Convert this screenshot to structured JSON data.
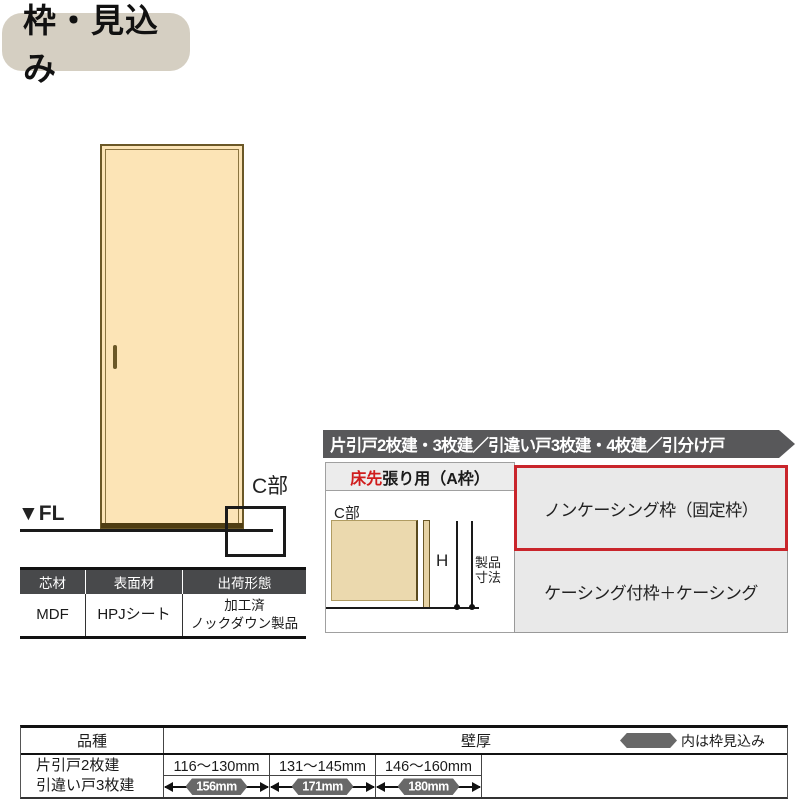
{
  "page_title": "枠・見込み",
  "door_figure": {
    "fl_label": "▼FL",
    "c_section_label": "C部"
  },
  "materials_table": {
    "headers": [
      "芯材",
      "表面材",
      "出荷形態"
    ],
    "core": "MDF",
    "surface": "HPJシート",
    "shipping_line1": "加工済",
    "shipping_line2": "ノックダウン製品"
  },
  "frame_panel": {
    "header": "片引戸2枚建・3枚建／引違い戸3枚建・4枚建／引分け戸",
    "floor_type_red": "床先",
    "floor_type_rest": "張り用（A枠）",
    "diagram": {
      "c_label": "C部",
      "h_label": "H",
      "dim_label_line1": "製品",
      "dim_label_line2": "寸法"
    },
    "options": [
      {
        "label": "ノンケーシング枠（固定枠）",
        "highlighted": true
      },
      {
        "label": "ケーシング付枠＋ケーシング",
        "highlighted": false
      }
    ]
  },
  "spec_table": {
    "col1_header": "品種",
    "col2_header": "壁厚",
    "legend": "内は枠見込み",
    "row_labels": [
      "片引戸2枚建",
      "引違い戸3枚建"
    ],
    "columns": [
      {
        "range": "116〜130mm",
        "frame": "156mm"
      },
      {
        "range": "131〜145mm",
        "frame": "171mm"
      },
      {
        "range": "146〜160mm",
        "frame": "180mm"
      }
    ]
  },
  "colors": {
    "accent_red": "#c9252b",
    "bar_dark": "#58585a",
    "badge_gray": "#686868",
    "door_tan": "#fce4b6",
    "title_beige": "#d5cfc2"
  }
}
